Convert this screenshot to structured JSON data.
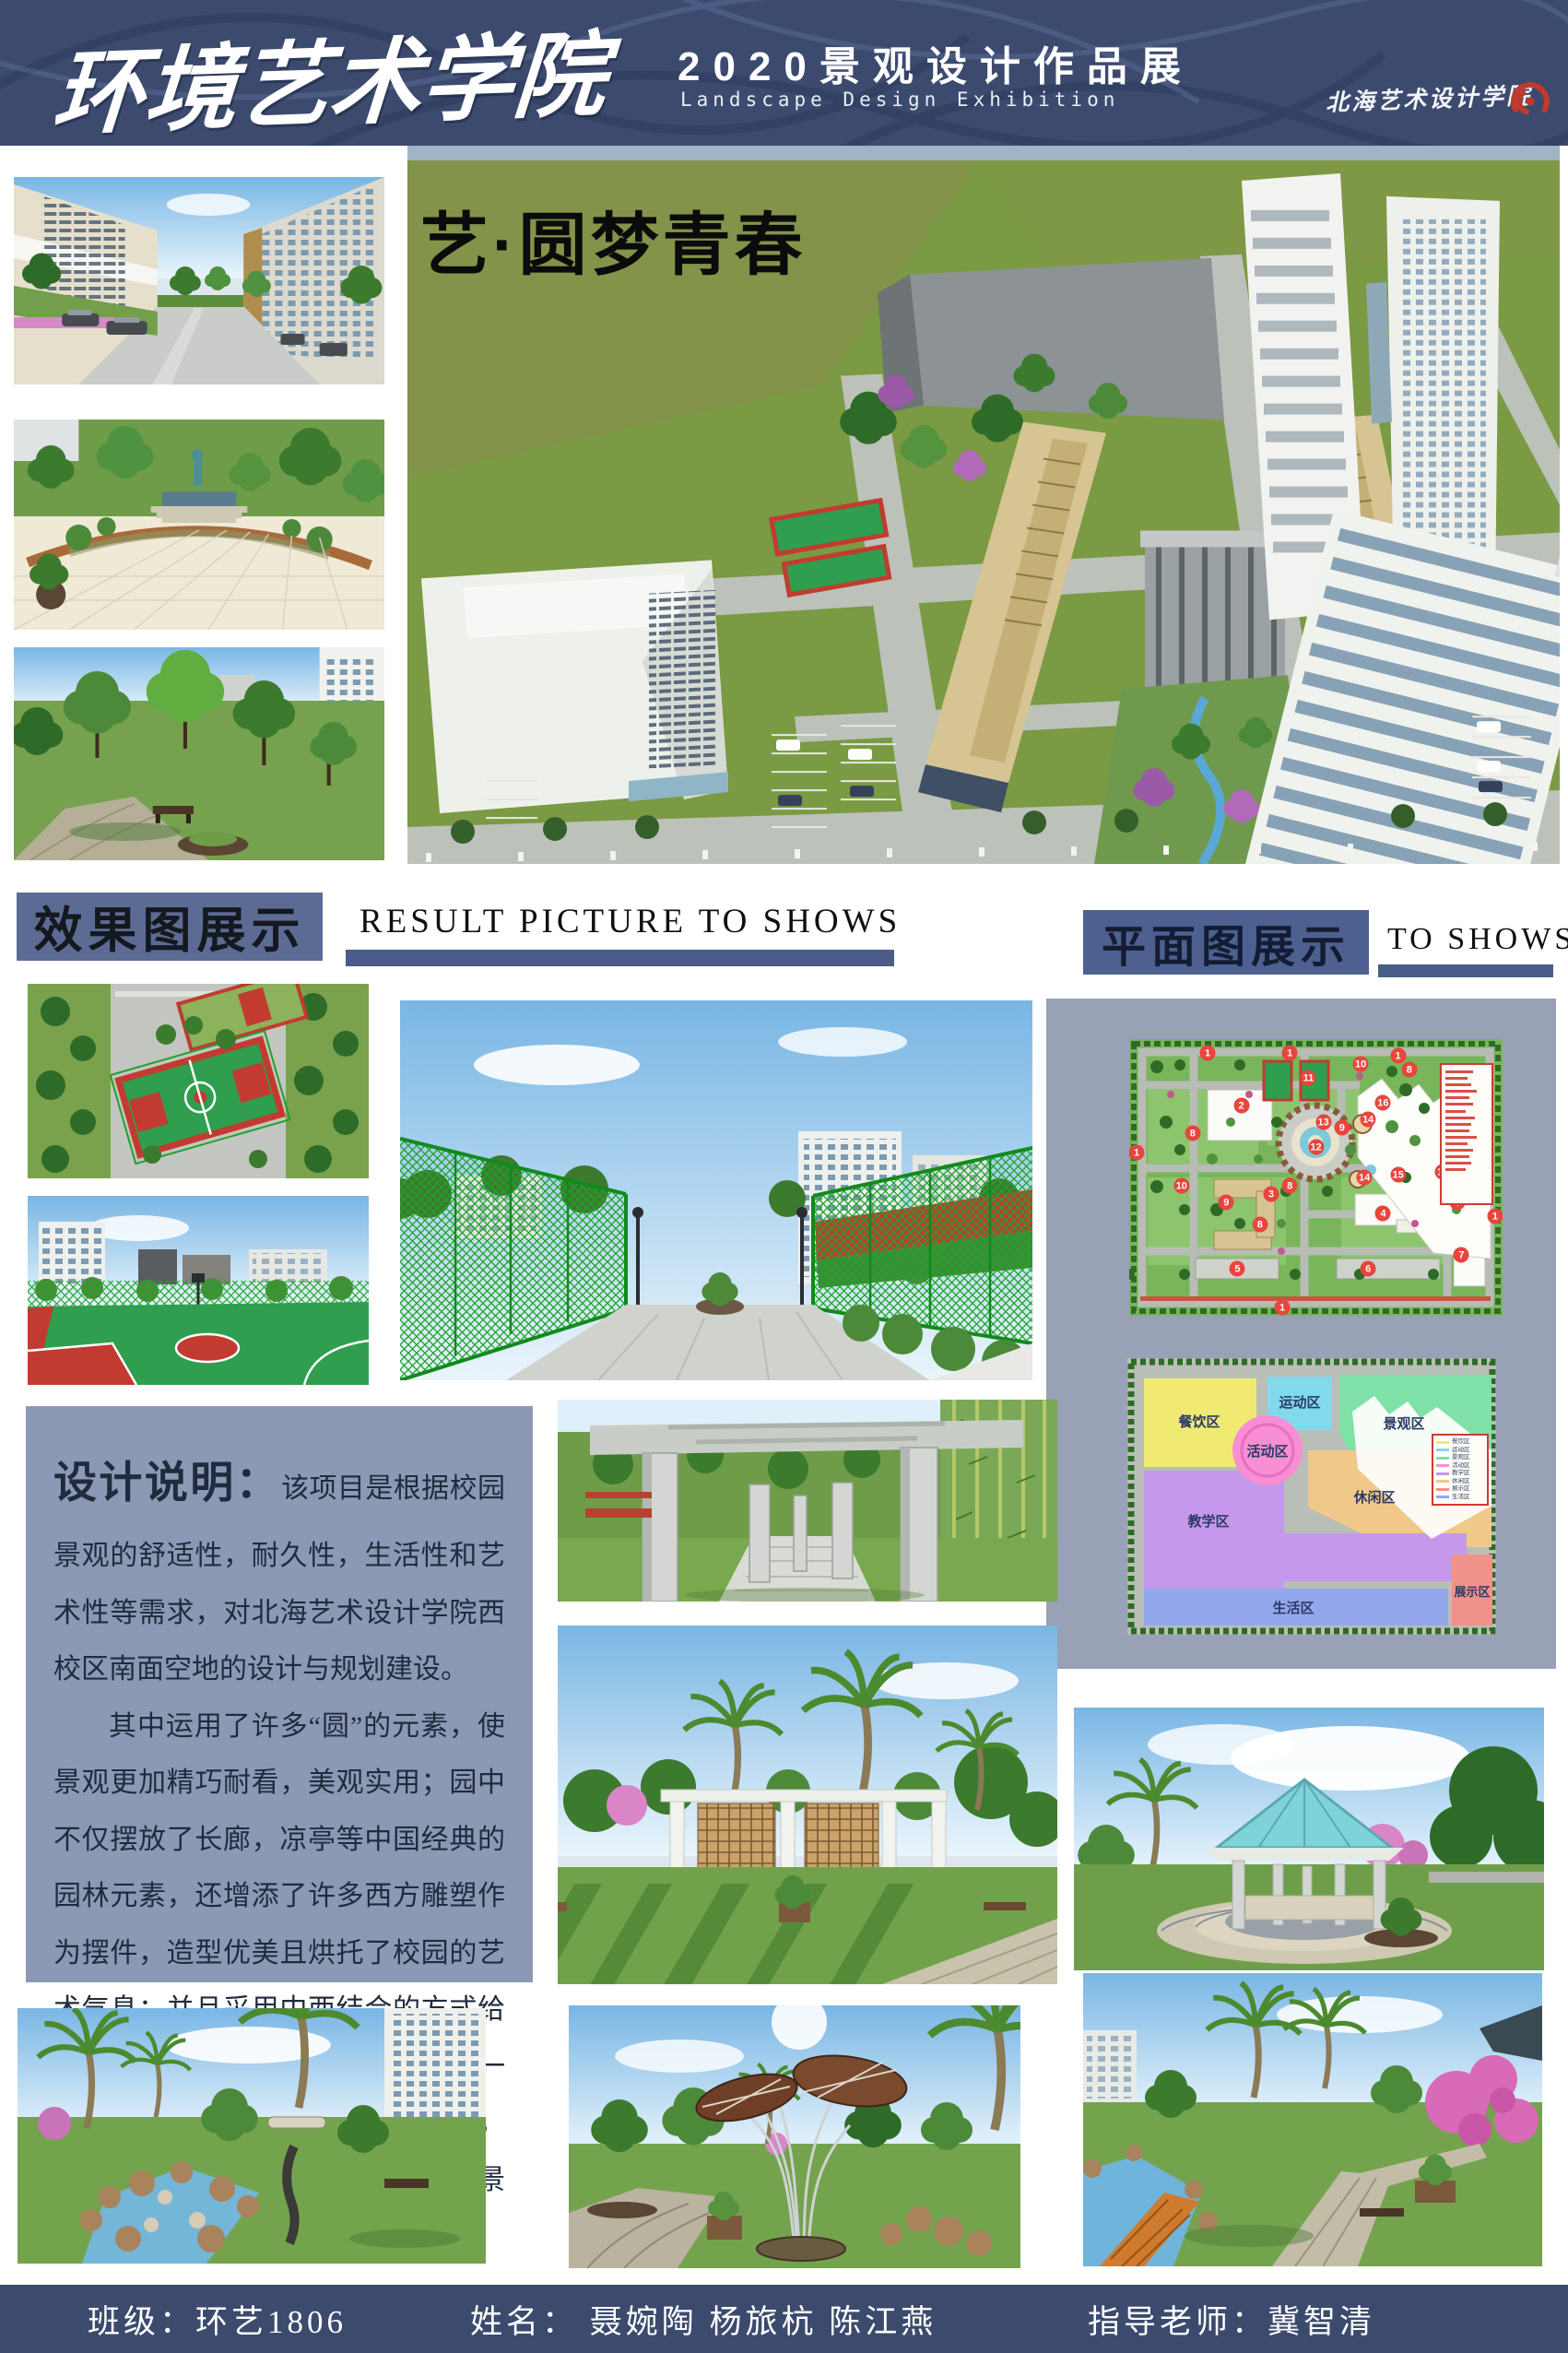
{
  "header": {
    "bg": "#3c4a6e",
    "school_name": "环境艺术学院",
    "title": "2020景观设计作品展",
    "subtitle": "Landscape Design Exhibition",
    "institute": "北海艺术设计学院",
    "logo_color": "#c0392e"
  },
  "hero": {
    "slogan": "艺·圆梦青春"
  },
  "section_results": {
    "title": "效果图展示",
    "subtitle": "RESULT PICTURE TO SHOWS",
    "box_color": "#5c6b93",
    "bar_color": "#4a5c88"
  },
  "section_plans": {
    "title": "平面图展示",
    "subtitle": "TO SHOWS"
  },
  "description": {
    "title": "设计说明：",
    "lead": "该项目是根据校园景观的舒适性，耐久性，生活性和艺术性等需求，对北海艺术设计学院西校区南面空地的设计与规划建设。",
    "body": "其中运用了许多“圆”的元素，使景观更加精巧耐看，美观实用；园中不仅摆放了长廊，凉亭等中国经典的园林元素，还增添了许多西方雕塑作为摆件，造型优美且烘托了校园的艺术气息；并且采用中西结合的方式给人们带来丰富的视觉体验。打造了一个布局合理，功能齐全，交通便利，环境优美且充满艺术气息的校园景观。"
  },
  "master_plan": {
    "marker_color": "#e8453c",
    "legend_line_count": 16,
    "markers": [
      {
        "n": "1",
        "x": 21,
        "y": 5
      },
      {
        "n": "1",
        "x": 43,
        "y": 5
      },
      {
        "n": "1",
        "x": 72,
        "y": 6
      },
      {
        "n": "1",
        "x": 2,
        "y": 41
      },
      {
        "n": "1",
        "x": 41,
        "y": 97
      },
      {
        "n": "1",
        "x": 98,
        "y": 64
      },
      {
        "n": "2",
        "x": 30,
        "y": 24
      },
      {
        "n": "3",
        "x": 38,
        "y": 56
      },
      {
        "n": "4",
        "x": 68,
        "y": 63
      },
      {
        "n": "5",
        "x": 29,
        "y": 83
      },
      {
        "n": "6",
        "x": 64,
        "y": 83
      },
      {
        "n": "7",
        "x": 89,
        "y": 78
      },
      {
        "n": "8",
        "x": 17,
        "y": 34
      },
      {
        "n": "8",
        "x": 43,
        "y": 53
      },
      {
        "n": "8",
        "x": 75,
        "y": 11
      },
      {
        "n": "8",
        "x": 35,
        "y": 67
      },
      {
        "n": "8",
        "x": 88,
        "y": 59
      },
      {
        "n": "9",
        "x": 26,
        "y": 59
      },
      {
        "n": "9",
        "x": 57,
        "y": 32
      },
      {
        "n": "10",
        "x": 14,
        "y": 53
      },
      {
        "n": "10",
        "x": 62,
        "y": 9
      },
      {
        "n": "10",
        "x": 84,
        "y": 48
      },
      {
        "n": "11",
        "x": 48,
        "y": 14
      },
      {
        "n": "12",
        "x": 50,
        "y": 39
      },
      {
        "n": "13",
        "x": 52,
        "y": 30
      },
      {
        "n": "14",
        "x": 64,
        "y": 29
      },
      {
        "n": "14",
        "x": 63,
        "y": 50
      },
      {
        "n": "15",
        "x": 72,
        "y": 49
      },
      {
        "n": "16",
        "x": 68,
        "y": 23
      }
    ]
  },
  "zoning_plan": {
    "zones": [
      {
        "label": "餐饮区",
        "color": "#f1ea72"
      },
      {
        "label": "运动区",
        "color": "#82d9ec"
      },
      {
        "label": "景观区",
        "color": "#7fe0a8"
      },
      {
        "label": "活动区",
        "color": "#f78fd2"
      },
      {
        "label": "教学区",
        "color": "#c598ec"
      },
      {
        "label": "休闲区",
        "color": "#f0c98a"
      },
      {
        "label": "展示区",
        "color": "#f0918a"
      },
      {
        "label": "生活区",
        "color": "#93a7ec"
      }
    ]
  },
  "footer": {
    "bg": "#3c4a6e",
    "class_text": "班级：环艺1806",
    "names_text": "姓名：  聂婉陶  杨旅杭  陈江燕",
    "advisor_text": "指导老师：冀智清"
  }
}
